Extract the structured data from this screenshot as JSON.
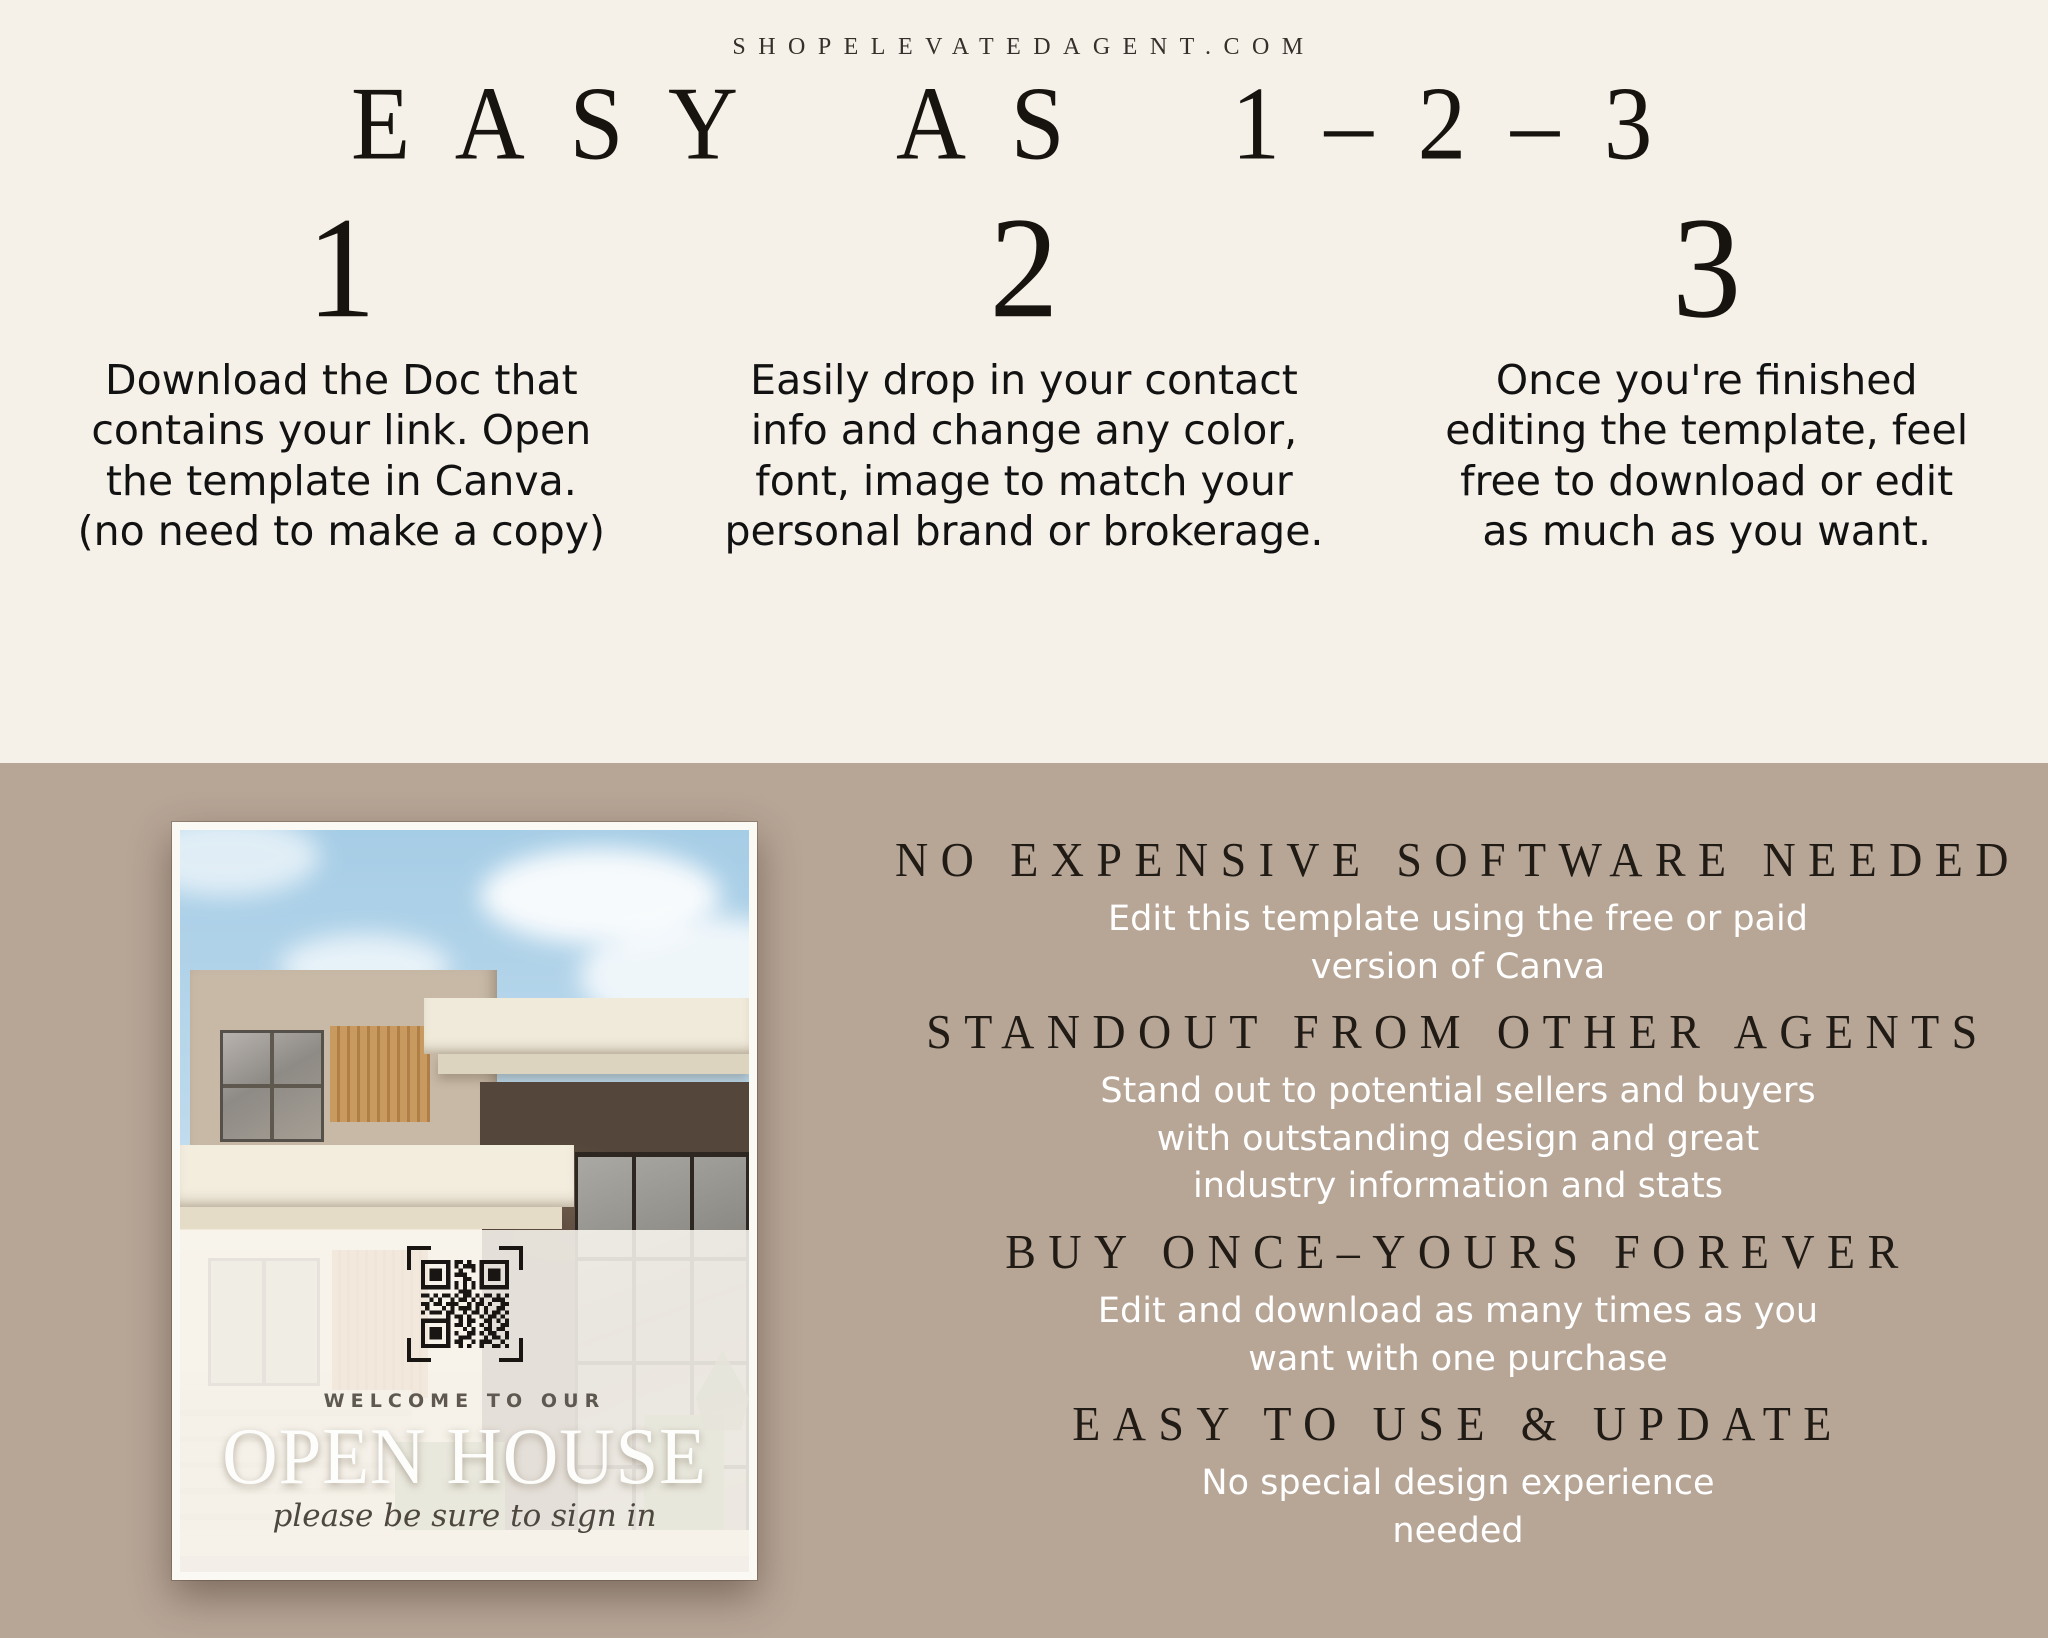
{
  "site": {
    "url": "SHOPELEVATEDAGENT.COM"
  },
  "hero": {
    "title": "EASY AS 1–2–3"
  },
  "steps": [
    {
      "number": "1",
      "text": "Download the Doc that\ncontains your link. Open\nthe template in Canva.\n(no need to make a copy)"
    },
    {
      "number": "2",
      "text": "Easily drop in your contact\ninfo and change any color,\nfont, image to match your\npersonal brand or brokerage."
    },
    {
      "number": "3",
      "text": "Once you're finished\nediting the template, feel\nfree to download or edit\nas much as you want."
    }
  ],
  "benefits": [
    {
      "heading": "NO EXPENSIVE SOFTWARE NEEDED",
      "body": "Edit this template using the free or paid\nversion of Canva"
    },
    {
      "heading": "STANDOUT FROM OTHER AGENTS",
      "body": "Stand out to potential sellers and buyers\nwith outstanding design and great\nindustry information and stats"
    },
    {
      "heading": "BUY ONCE–YOURS FOREVER",
      "body": "Edit and download as many times as you\nwant with one purchase"
    },
    {
      "heading": "EASY TO USE & UPDATE",
      "body": "No special design experience\nneeded"
    }
  ],
  "flyer": {
    "welcome": "WELCOME TO OUR",
    "title": "OPEN HOUSE",
    "tagline": "please be sure to sign in",
    "qr_icon": "qr-code-icon"
  },
  "colors": {
    "cream": "#f6f1e8",
    "taupe": "#b7a596",
    "ink": "#1d1a16",
    "white_text": "#ffffff"
  }
}
